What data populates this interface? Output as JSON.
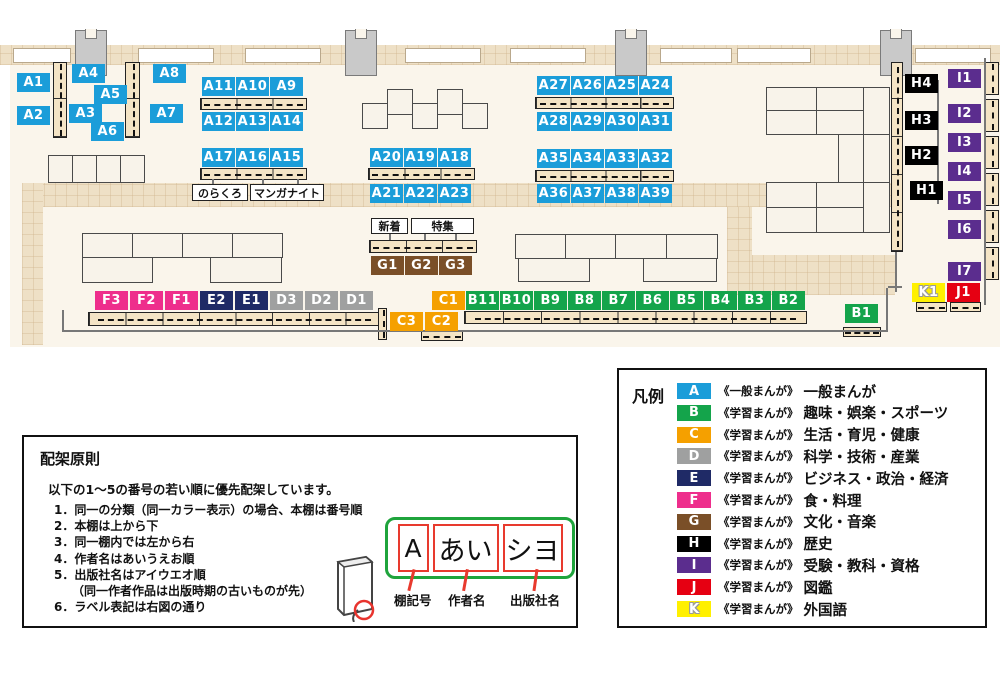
{
  "palette": {
    "floor": "#faf5eb",
    "walkway": "#eee0c6",
    "categories": {
      "A": "#1b9dd9",
      "B": "#14a44b",
      "C": "#f5a000",
      "D": "#9fa0a0",
      "E": "#1f2a66",
      "F": "#ee2e8c",
      "G": "#7a4f28",
      "H": "#000000",
      "I": "#5b2d8e",
      "J": "#e60012",
      "K": "#fff000"
    }
  },
  "map": {
    "walkways": [
      {
        "x": 0,
        "y": 45,
        "w": 1000,
        "h": 20
      },
      {
        "x": 22,
        "y": 183,
        "w": 873,
        "h": 24
      },
      {
        "x": 22,
        "y": 183,
        "w": 21,
        "h": 162
      },
      {
        "x": 727,
        "y": 207,
        "w": 25,
        "h": 88
      },
      {
        "x": 752,
        "y": 255,
        "w": 143,
        "h": 40
      }
    ],
    "windows": [
      {
        "x": 13,
        "y": 48,
        "w": 58,
        "h": 15
      },
      {
        "x": 138,
        "y": 48,
        "w": 76,
        "h": 15
      },
      {
        "x": 245,
        "y": 48,
        "w": 76,
        "h": 15
      },
      {
        "x": 405,
        "y": 48,
        "w": 76,
        "h": 15
      },
      {
        "x": 510,
        "y": 48,
        "w": 76,
        "h": 15
      },
      {
        "x": 660,
        "y": 48,
        "w": 72,
        "h": 15
      },
      {
        "x": 737,
        "y": 48,
        "w": 74,
        "h": 15
      },
      {
        "x": 915,
        "y": 48,
        "w": 76,
        "h": 15
      }
    ],
    "pillars": [
      {
        "x": 75,
        "y": 30,
        "w": 32,
        "h": 46
      },
      {
        "x": 345,
        "y": 30,
        "w": 32,
        "h": 46
      },
      {
        "x": 615,
        "y": 30,
        "w": 32,
        "h": 46
      },
      {
        "x": 880,
        "y": 30,
        "w": 32,
        "h": 46
      }
    ],
    "tables": [
      {
        "x": 362,
        "y": 103,
        "w": 26,
        "h": 26
      },
      {
        "x": 387,
        "y": 89,
        "w": 26,
        "h": 26
      },
      {
        "x": 412,
        "y": 103,
        "w": 26,
        "h": 26
      },
      {
        "x": 437,
        "y": 89,
        "w": 26,
        "h": 26
      },
      {
        "x": 462,
        "y": 103,
        "w": 26,
        "h": 26
      },
      {
        "x": 48,
        "y": 155,
        "w": 25,
        "h": 28
      },
      {
        "x": 72,
        "y": 155,
        "w": 25,
        "h": 28
      },
      {
        "x": 96,
        "y": 155,
        "w": 25,
        "h": 28
      },
      {
        "x": 120,
        "y": 155,
        "w": 25,
        "h": 28
      },
      {
        "x": 82,
        "y": 233,
        "w": 51,
        "h": 25
      },
      {
        "x": 132,
        "y": 233,
        "w": 51,
        "h": 25
      },
      {
        "x": 182,
        "y": 233,
        "w": 51,
        "h": 25
      },
      {
        "x": 232,
        "y": 233,
        "w": 51,
        "h": 25
      },
      {
        "x": 82,
        "y": 257,
        "w": 71,
        "h": 26
      },
      {
        "x": 210,
        "y": 257,
        "w": 72,
        "h": 26
      },
      {
        "x": 515,
        "y": 234,
        "w": 51,
        "h": 25
      },
      {
        "x": 565,
        "y": 234,
        "w": 51,
        "h": 25
      },
      {
        "x": 615,
        "y": 234,
        "w": 52,
        "h": 25
      },
      {
        "x": 666,
        "y": 234,
        "w": 52,
        "h": 25
      },
      {
        "x": 518,
        "y": 258,
        "w": 72,
        "h": 24
      },
      {
        "x": 643,
        "y": 258,
        "w": 74,
        "h": 24
      },
      {
        "x": 766,
        "y": 87,
        "w": 51,
        "h": 24
      },
      {
        "x": 816,
        "y": 87,
        "w": 48,
        "h": 24
      },
      {
        "x": 863,
        "y": 87,
        "w": 27,
        "h": 48
      },
      {
        "x": 766,
        "y": 110,
        "w": 51,
        "h": 25
      },
      {
        "x": 816,
        "y": 110,
        "w": 48,
        "h": 25
      },
      {
        "x": 838,
        "y": 134,
        "w": 26,
        "h": 49
      },
      {
        "x": 863,
        "y": 134,
        "w": 27,
        "h": 49
      },
      {
        "x": 766,
        "y": 182,
        "w": 51,
        "h": 26
      },
      {
        "x": 816,
        "y": 182,
        "w": 48,
        "h": 26
      },
      {
        "x": 863,
        "y": 182,
        "w": 27,
        "h": 51
      },
      {
        "x": 766,
        "y": 207,
        "w": 51,
        "h": 26
      },
      {
        "x": 816,
        "y": 207,
        "w": 48,
        "h": 26
      }
    ],
    "shelves": [
      {
        "x": 53,
        "y": 62,
        "w": 14,
        "h": 76,
        "o": "v",
        "segs": 2
      },
      {
        "x": 125,
        "y": 62,
        "w": 15,
        "h": 76,
        "o": "v",
        "segs": 2
      },
      {
        "x": 200,
        "y": 98,
        "w": 107,
        "h": 12,
        "o": "h",
        "segs": 3
      },
      {
        "x": 200,
        "y": 168,
        "w": 107,
        "h": 12,
        "o": "h",
        "segs": 3
      },
      {
        "x": 368,
        "y": 168,
        "w": 107,
        "h": 12,
        "o": "h",
        "segs": 3
      },
      {
        "x": 535,
        "y": 97,
        "w": 139,
        "h": 12,
        "o": "h",
        "segs": 4
      },
      {
        "x": 535,
        "y": 170,
        "w": 139,
        "h": 12,
        "o": "h",
        "segs": 4
      },
      {
        "x": 369,
        "y": 240,
        "w": 108,
        "h": 13,
        "o": "h",
        "segs": 3
      },
      {
        "x": 88,
        "y": 312,
        "w": 293,
        "h": 14,
        "o": "h",
        "segs": 8
      },
      {
        "x": 378,
        "y": 308,
        "w": 9,
        "h": 32,
        "o": "v",
        "segs": 1
      },
      {
        "x": 421,
        "y": 331,
        "w": 42,
        "h": 10,
        "o": "h",
        "segs": 1
      },
      {
        "x": 464,
        "y": 311,
        "w": 343,
        "h": 13,
        "o": "h",
        "segs": 9
      },
      {
        "x": 843,
        "y": 327,
        "w": 38,
        "h": 10,
        "o": "h",
        "segs": 1
      },
      {
        "x": 916,
        "y": 302,
        "w": 31,
        "h": 10,
        "o": "h",
        "segs": 1
      },
      {
        "x": 950,
        "y": 302,
        "w": 31,
        "h": 10,
        "o": "h",
        "segs": 1
      },
      {
        "x": 891,
        "y": 62,
        "w": 12,
        "h": 190,
        "o": "v",
        "segs": 5
      },
      {
        "x": 985,
        "y": 62,
        "w": 14,
        "h": 33,
        "o": "v",
        "segs": 1
      },
      {
        "x": 985,
        "y": 99,
        "w": 14,
        "h": 33,
        "o": "v",
        "segs": 1
      },
      {
        "x": 985,
        "y": 136,
        "w": 14,
        "h": 33,
        "o": "v",
        "segs": 1
      },
      {
        "x": 985,
        "y": 173,
        "w": 14,
        "h": 33,
        "o": "v",
        "segs": 1
      },
      {
        "x": 985,
        "y": 210,
        "w": 14,
        "h": 33,
        "o": "v",
        "segs": 1
      },
      {
        "x": 985,
        "y": 247,
        "w": 14,
        "h": 33,
        "o": "v",
        "segs": 1
      }
    ],
    "lines": [
      {
        "x": 62,
        "y": 330,
        "w": 824,
        "h": 2
      },
      {
        "x": 62,
        "y": 310,
        "w": 2,
        "h": 22
      },
      {
        "x": 886,
        "y": 288,
        "w": 2,
        "h": 44
      },
      {
        "x": 888,
        "y": 286,
        "w": 14,
        "h": 2
      },
      {
        "x": 984,
        "y": 58,
        "w": 2,
        "h": 247
      },
      {
        "x": 937,
        "y": 80,
        "w": 2,
        "h": 124
      },
      {
        "x": 895,
        "y": 252,
        "w": 2,
        "h": 40
      },
      {
        "x": 389,
        "y": 234,
        "w": 2,
        "h": 6
      },
      {
        "x": 424,
        "y": 234,
        "w": 2,
        "h": 6
      },
      {
        "x": 455,
        "y": 234,
        "w": 2,
        "h": 6
      },
      {
        "x": 212,
        "y": 179,
        "w": 2,
        "h": 6
      },
      {
        "x": 262,
        "y": 179,
        "w": 2,
        "h": 6
      },
      {
        "x": 297,
        "y": 179,
        "w": 2,
        "h": 6
      }
    ],
    "chips": [
      {
        "id": "A1",
        "x": 17,
        "y": 73
      },
      {
        "id": "A2",
        "x": 17,
        "y": 106
      },
      {
        "id": "A4",
        "x": 72,
        "y": 64
      },
      {
        "id": "A5",
        "x": 94,
        "y": 85
      },
      {
        "id": "A3",
        "x": 69,
        "y": 104
      },
      {
        "id": "A6",
        "x": 91,
        "y": 122
      },
      {
        "id": "A8",
        "x": 153,
        "y": 64
      },
      {
        "id": "A7",
        "x": 150,
        "y": 104
      },
      {
        "id": "A11",
        "x": 202,
        "y": 77
      },
      {
        "id": "A10",
        "x": 236,
        "y": 77
      },
      {
        "id": "A9",
        "x": 270,
        "y": 77
      },
      {
        "id": "A12",
        "x": 202,
        "y": 112
      },
      {
        "id": "A13",
        "x": 236,
        "y": 112
      },
      {
        "id": "A14",
        "x": 270,
        "y": 112
      },
      {
        "id": "A17",
        "x": 202,
        "y": 148
      },
      {
        "id": "A16",
        "x": 236,
        "y": 148
      },
      {
        "id": "A15",
        "x": 270,
        "y": 148
      },
      {
        "id": "A20",
        "x": 370,
        "y": 148
      },
      {
        "id": "A19",
        "x": 404,
        "y": 148
      },
      {
        "id": "A18",
        "x": 438,
        "y": 148
      },
      {
        "id": "A21",
        "x": 370,
        "y": 184
      },
      {
        "id": "A22",
        "x": 404,
        "y": 184
      },
      {
        "id": "A23",
        "x": 438,
        "y": 184
      },
      {
        "id": "A27",
        "x": 537,
        "y": 76
      },
      {
        "id": "A26",
        "x": 571,
        "y": 76
      },
      {
        "id": "A25",
        "x": 605,
        "y": 76
      },
      {
        "id": "A24",
        "x": 639,
        "y": 76
      },
      {
        "id": "A28",
        "x": 537,
        "y": 112
      },
      {
        "id": "A29",
        "x": 571,
        "y": 112
      },
      {
        "id": "A30",
        "x": 605,
        "y": 112
      },
      {
        "id": "A31",
        "x": 639,
        "y": 112
      },
      {
        "id": "A35",
        "x": 537,
        "y": 149
      },
      {
        "id": "A34",
        "x": 571,
        "y": 149
      },
      {
        "id": "A33",
        "x": 605,
        "y": 149
      },
      {
        "id": "A32",
        "x": 639,
        "y": 149
      },
      {
        "id": "A36",
        "x": 537,
        "y": 184
      },
      {
        "id": "A37",
        "x": 571,
        "y": 184
      },
      {
        "id": "A38",
        "x": 605,
        "y": 184
      },
      {
        "id": "A39",
        "x": 639,
        "y": 184
      },
      {
        "id": "G1",
        "x": 371,
        "y": 256
      },
      {
        "id": "G2",
        "x": 405,
        "y": 256
      },
      {
        "id": "G3",
        "x": 439,
        "y": 256
      },
      {
        "id": "F3",
        "x": 95,
        "y": 291
      },
      {
        "id": "F2",
        "x": 130,
        "y": 291
      },
      {
        "id": "F1",
        "x": 165,
        "y": 291
      },
      {
        "id": "E2",
        "x": 200,
        "y": 291
      },
      {
        "id": "E1",
        "x": 235,
        "y": 291
      },
      {
        "id": "D3",
        "x": 270,
        "y": 291
      },
      {
        "id": "D2",
        "x": 305,
        "y": 291
      },
      {
        "id": "D1",
        "x": 340,
        "y": 291
      },
      {
        "id": "C1",
        "x": 432,
        "y": 291
      },
      {
        "id": "C3",
        "x": 390,
        "y": 312
      },
      {
        "id": "C2",
        "x": 425,
        "y": 312
      },
      {
        "id": "B11",
        "x": 466,
        "y": 291
      },
      {
        "id": "B10",
        "x": 500,
        "y": 291
      },
      {
        "id": "B9",
        "x": 534,
        "y": 291
      },
      {
        "id": "B8",
        "x": 568,
        "y": 291
      },
      {
        "id": "B7",
        "x": 602,
        "y": 291
      },
      {
        "id": "B6",
        "x": 636,
        "y": 291
      },
      {
        "id": "B5",
        "x": 670,
        "y": 291
      },
      {
        "id": "B4",
        "x": 704,
        "y": 291
      },
      {
        "id": "B3",
        "x": 738,
        "y": 291
      },
      {
        "id": "B2",
        "x": 772,
        "y": 291
      },
      {
        "id": "B1",
        "x": 845,
        "y": 304
      },
      {
        "id": "H4",
        "x": 905,
        "y": 74
      },
      {
        "id": "H3",
        "x": 905,
        "y": 111
      },
      {
        "id": "H2",
        "x": 905,
        "y": 146
      },
      {
        "id": "H1",
        "x": 910,
        "y": 181
      },
      {
        "id": "I1",
        "x": 948,
        "y": 69
      },
      {
        "id": "I2",
        "x": 948,
        "y": 104
      },
      {
        "id": "I3",
        "x": 948,
        "y": 133
      },
      {
        "id": "I4",
        "x": 948,
        "y": 162
      },
      {
        "id": "I5",
        "x": 948,
        "y": 191
      },
      {
        "id": "I6",
        "x": 948,
        "y": 220
      },
      {
        "id": "I7",
        "x": 948,
        "y": 262
      },
      {
        "id": "K1",
        "x": 912,
        "y": 283
      },
      {
        "id": "J1",
        "x": 947,
        "y": 283
      }
    ],
    "notes": [
      {
        "text": "のらくろ",
        "x": 192,
        "y": 184,
        "w": 56,
        "h": 17
      },
      {
        "text": "マンガナイト",
        "x": 250,
        "y": 184,
        "w": 74,
        "h": 17
      },
      {
        "text": "新着",
        "x": 371,
        "y": 218,
        "w": 37,
        "h": 16
      },
      {
        "text": "特集",
        "x": 411,
        "y": 218,
        "w": 63,
        "h": 16
      }
    ]
  },
  "legend": {
    "title": "凡例",
    "rows": [
      {
        "code": "A",
        "bracket": "《一般まんが》",
        "category": "一般まんが"
      },
      {
        "code": "B",
        "bracket": "《学習まんが》",
        "category": "趣味・娯楽・スポーツ"
      },
      {
        "code": "C",
        "bracket": "《学習まんが》",
        "category": "生活・育児・健康"
      },
      {
        "code": "D",
        "bracket": "《学習まんが》",
        "category": "科学・技術・産業"
      },
      {
        "code": "E",
        "bracket": "《学習まんが》",
        "category": "ビジネス・政治・経済"
      },
      {
        "code": "F",
        "bracket": "《学習まんが》",
        "category": "食・料理"
      },
      {
        "code": "G",
        "bracket": "《学習まんが》",
        "category": "文化・音楽"
      },
      {
        "code": "H",
        "bracket": "《学習まんが》",
        "category": "歴史"
      },
      {
        "code": "I",
        "bracket": "《学習まんが》",
        "category": "受験・教科・資格"
      },
      {
        "code": "J",
        "bracket": "《学習まんが》",
        "category": "図鑑"
      },
      {
        "code": "K",
        "bracket": "《学習まんが》",
        "category": "外国語"
      }
    ]
  },
  "principles": {
    "title": "配架原則",
    "intro": "以下の1～5の番号の若い順に優先配架しています。",
    "items": [
      "1．同一の分類（同一カラー表示）の場合、本棚は番号順",
      "2．本棚は上から下",
      "3．同一棚内では左から右",
      "4．作者名はあいうえお順",
      "5．出版社名はアイウエオ順",
      "　　（同一作者作品は出版時期の古いものが先）",
      "6．ラベル表記は右図の通り"
    ]
  },
  "label_example": {
    "segments": [
      "A",
      "あい",
      "シヨ"
    ],
    "captions": [
      "棚記号",
      "作者名",
      "出版社名"
    ]
  }
}
